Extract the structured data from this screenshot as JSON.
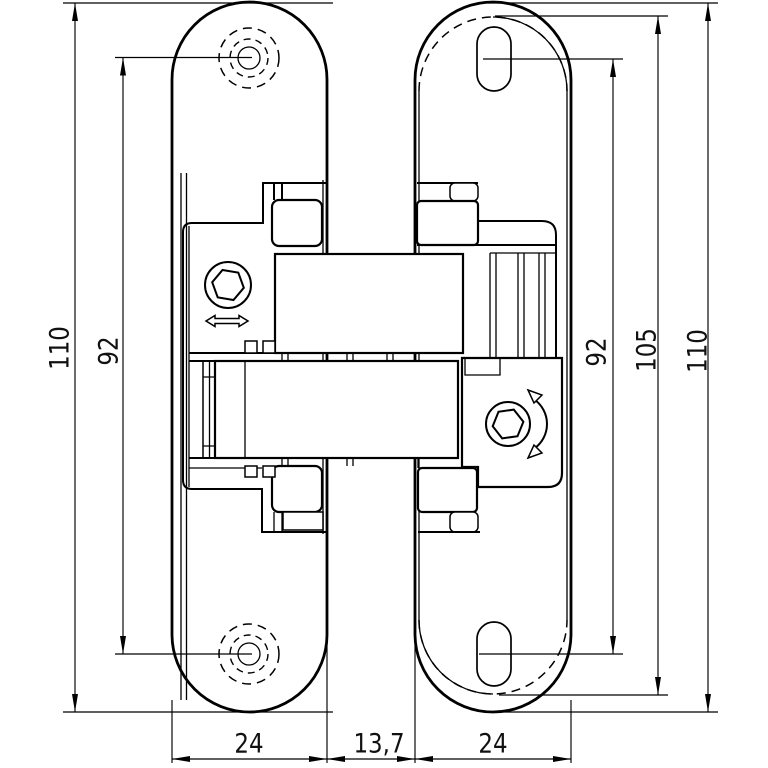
{
  "drawing": {
    "type": "technical-dimension-drawing",
    "subject": "concealed-hinge-front-view",
    "colors": {
      "line": "#000000",
      "background": "#ffffff"
    },
    "icons": [
      "hex-socket-icon",
      "lateral-adjustment-arrow-icon",
      "rotation-adjustment-arrow-icon",
      "screw-hole-icon",
      "slotted-hole-icon"
    ],
    "dims": {
      "left_total": "110",
      "left_hole_spacing": "92",
      "right_slot_spacing": "92",
      "right_cutout_height": "105",
      "right_total": "110",
      "bottom_left_width": "24",
      "bottom_gap": "13,7",
      "bottom_right_width": "24"
    }
  }
}
